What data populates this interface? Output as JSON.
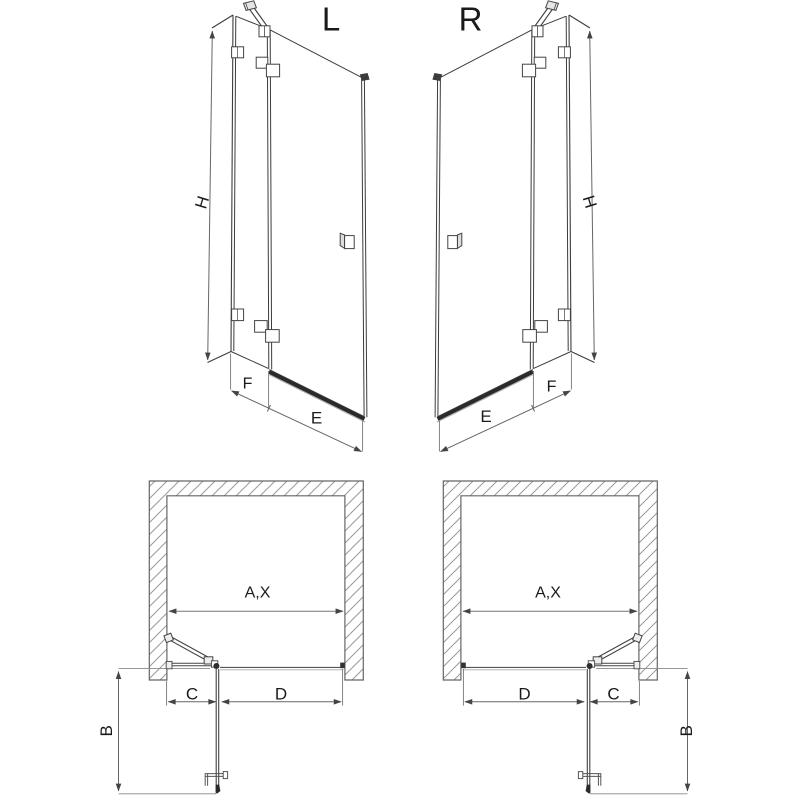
{
  "page": {
    "background": "#ffffff",
    "description": "Technical drawing of hinged shower door, left (L) and right (R) versions: two perspective elevation views and two plan views with dimension letters"
  },
  "colors": {
    "line": "#3c3c3c",
    "profile_dark": "#2b2b2b",
    "dimension": "#777777",
    "wall_outline": "#666666",
    "hatch": "#999999",
    "text": "#1a1a1a"
  },
  "views": {
    "elevation_left": {
      "label": "L",
      "dim_height": "H",
      "dim_fixed": "F",
      "dim_door": "E"
    },
    "elevation_right": {
      "label": "R",
      "dim_height": "H",
      "dim_fixed": "F",
      "dim_door": "E"
    },
    "plan_left": {
      "dim_opening": "A,X",
      "dim_fixed": "C",
      "dim_door": "D",
      "dim_swing": "B"
    },
    "plan_right": {
      "dim_opening": "A,X",
      "dim_fixed": "C",
      "dim_door": "D",
      "dim_swing": "B"
    }
  }
}
